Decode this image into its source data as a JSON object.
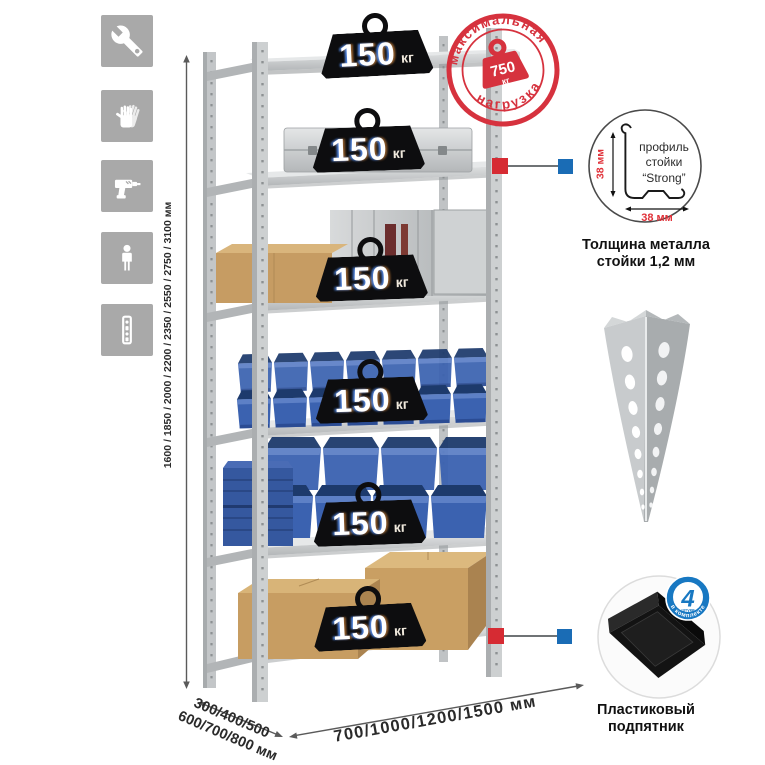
{
  "icons_panel": {
    "items": [
      {
        "name": "wrench"
      },
      {
        "name": "gloves"
      },
      {
        "name": "drill"
      },
      {
        "name": "person"
      },
      {
        "name": "upright-profile"
      }
    ]
  },
  "rack": {
    "shelf_count": 6,
    "badge_value": "150",
    "badge_unit": "кг"
  },
  "stamp": {
    "arc_top": "максимальная",
    "arc_bottom": "нагрузка",
    "value": "750",
    "unit": "кг"
  },
  "dimensions": {
    "height": "1600 / 1850 / 2000 / 2200 / 2350 / 2550 / 2750 / 3100 мм",
    "depth_line1": "300/400/500",
    "depth_line2": "600/700/800 мм",
    "width": "700/1000/1200/1500 мм"
  },
  "profile_callout": {
    "vertical_dim": "38 мм",
    "horizontal_dim": "38 мм",
    "label_line1": "профиль",
    "label_line2": "стойки",
    "label_line3": "“Strong”",
    "caption_line1": "Толщина металла",
    "caption_line2": "стойки 1,2 мм"
  },
  "foot_callout": {
    "badge_number": "4",
    "badge_unit": "штуки",
    "badge_arc": "в комплекте",
    "caption_line1": "Пластиковый",
    "caption_line2": "подпятник"
  },
  "colors": {
    "stamp_red": "#d6323e",
    "callout_red": "#d62b33",
    "callout_blue": "#1a6cb5",
    "bin_blue": "#3b62b0"
  }
}
